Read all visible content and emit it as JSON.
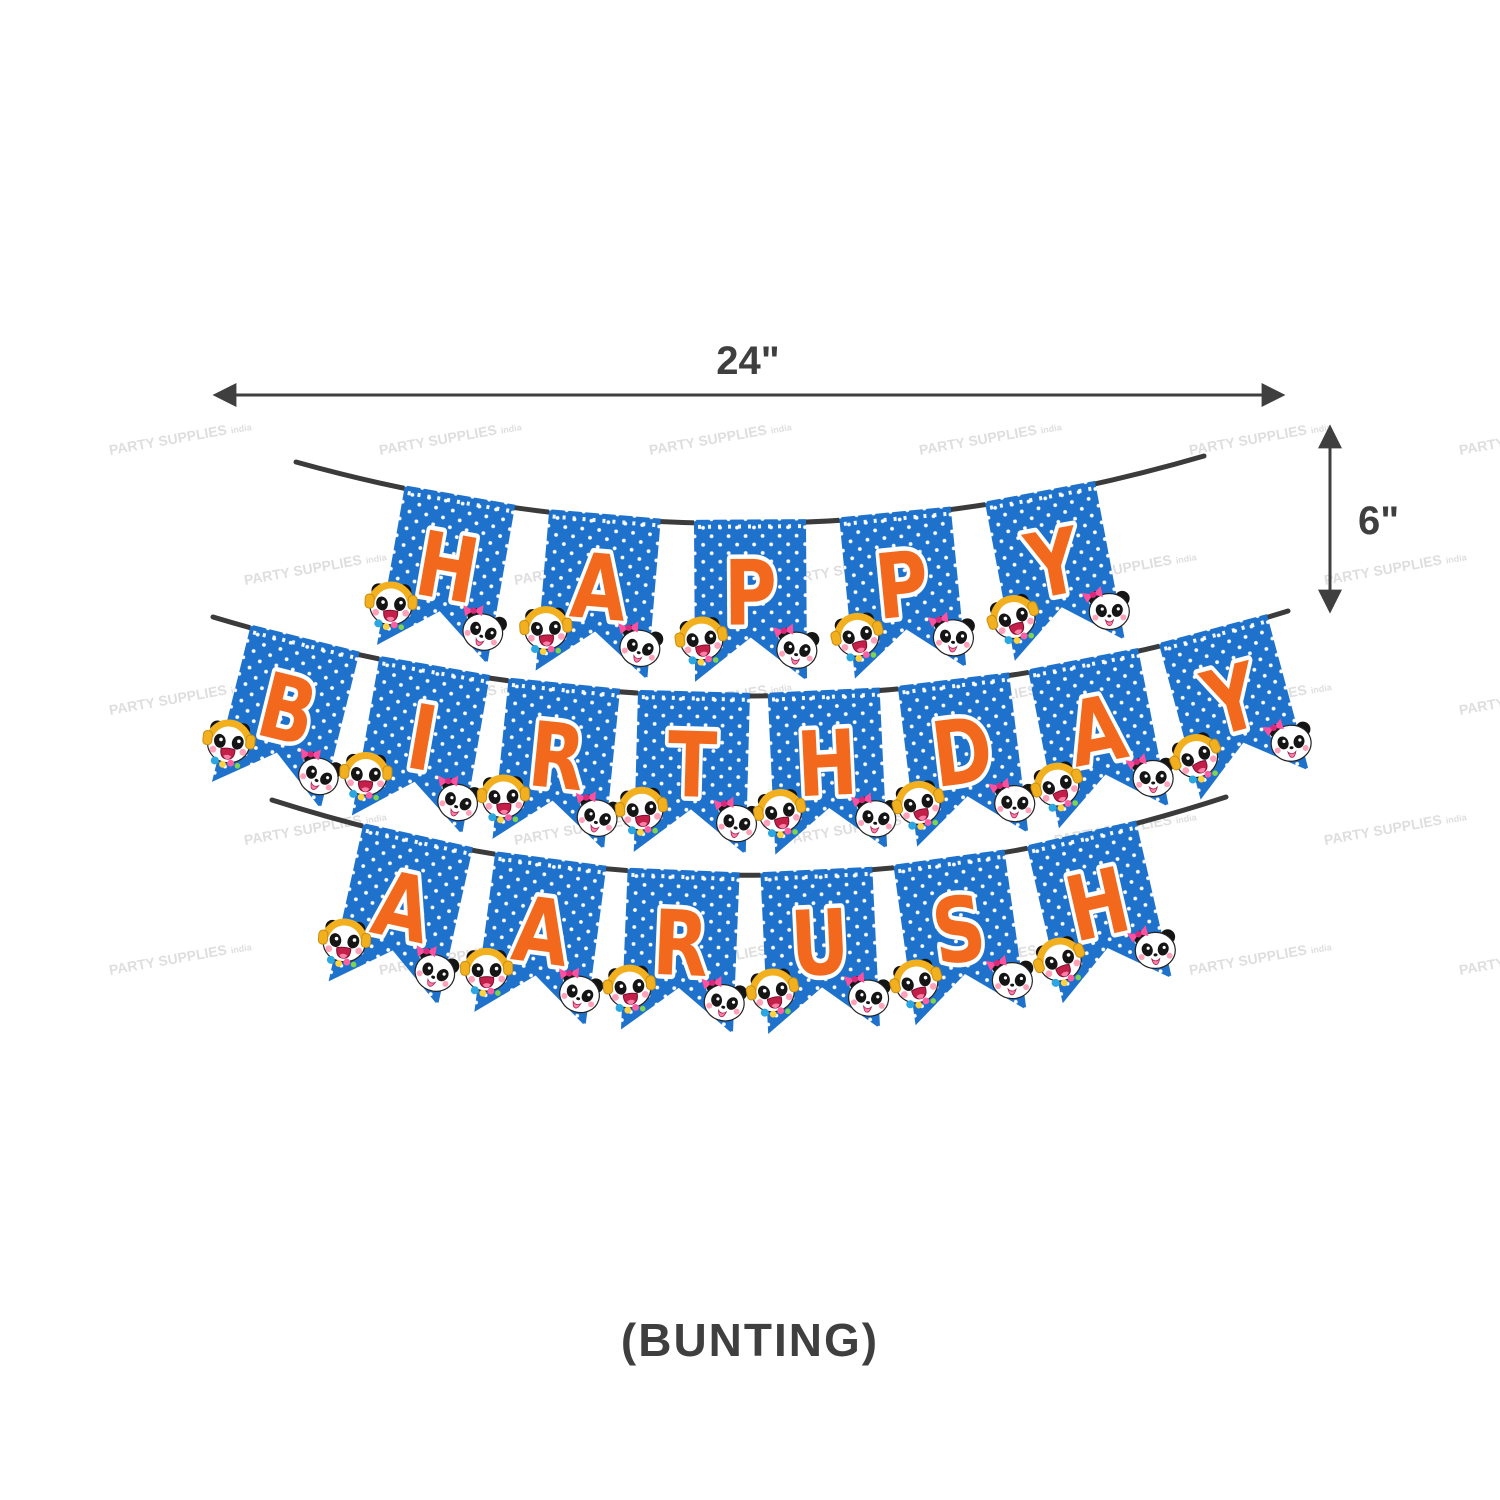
{
  "banner": {
    "rows": [
      {
        "word": "HAPPY"
      },
      {
        "word": "BIRTHDAY"
      },
      {
        "word": "AARUSH"
      }
    ],
    "flag_color": "#1f72cb",
    "flag_dot_color": "#ffffff",
    "letter_color": "#f2691d",
    "string_color": "#3b3b3b",
    "corner_art": [
      "panda-with-headphones",
      "panda-with-pink-bow"
    ]
  },
  "dimensions": {
    "width_label": "24\"",
    "height_label": "6\"",
    "annotation_color": "#3f3f3f"
  },
  "caption": "(BUNTING)",
  "watermark": {
    "text": "PARTY SUPPLIES",
    "suffix": "india"
  }
}
